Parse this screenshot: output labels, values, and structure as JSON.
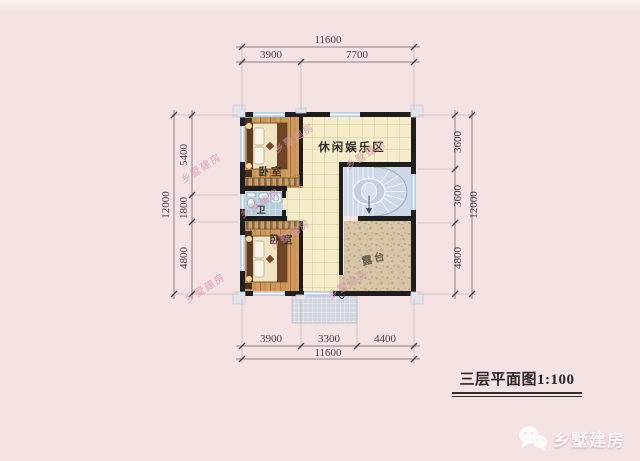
{
  "page": {
    "background": "#f5e3e4"
  },
  "plan": {
    "rooms": {
      "bedroom_top": "卧室",
      "bedroom_bottom": "卧室",
      "leisure": "休闲娱乐区",
      "bath": "卫",
      "terrace": "露台"
    },
    "dimensions": {
      "top": {
        "overall": "11600",
        "seg1": "3900",
        "seg2": "7700"
      },
      "bottom": {
        "overall": "11600",
        "seg1": "3900",
        "seg2": "3300",
        "seg3": "4400"
      },
      "left": {
        "overall": "12000",
        "seg1": "5400",
        "seg2": "1800",
        "seg3": "4800"
      },
      "right": {
        "overall": "12000",
        "seg1": "3600",
        "seg2": "3600",
        "seg3": "4800"
      }
    }
  },
  "title": {
    "text": "三层平面图1:100"
  },
  "watermark": {
    "text": "乡墅建房"
  },
  "logo": {
    "text": "乡墅建房"
  },
  "colors": {
    "wall": "#1e1e1e",
    "window": "#b9cee6",
    "wood_floor": "#d19c61",
    "tile_floor": "#f5edca",
    "terrace_floor": "#d6c6a7",
    "stair": "#cfd9e6",
    "watermark": "#d795ab"
  }
}
